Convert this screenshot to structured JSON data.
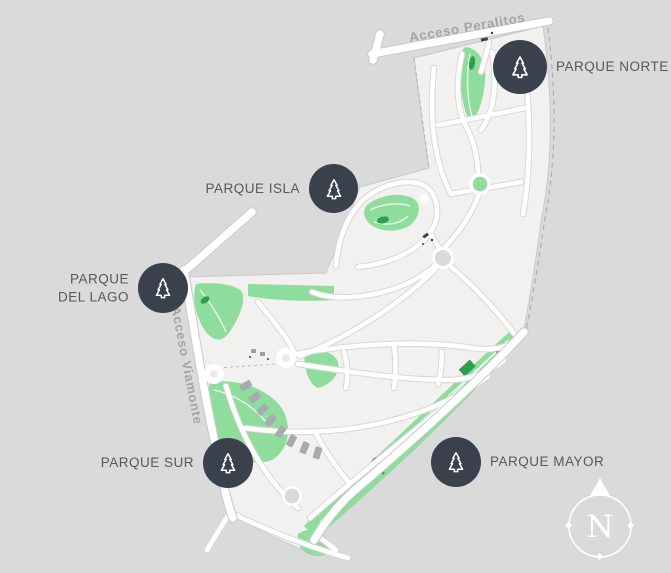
{
  "map": {
    "colors": {
      "background": "#dadada",
      "parcel": "#f2f1f0",
      "road": "#ffffff",
      "park_green": "#8edd9d",
      "park_green_dark": "#2f9e4f",
      "badge": "#3a404c",
      "park_label": "#54585f",
      "road_label": "#a2a2a2"
    },
    "roads": {
      "north": "Acceso Peralitos",
      "west": "Acceso Viamonte"
    },
    "parks": [
      {
        "id": "norte",
        "label": "PARQUE NORTE"
      },
      {
        "id": "isla",
        "label": "PARQUE ISLA"
      },
      {
        "id": "del_lago",
        "label": "PARQUE DEL LAGO"
      },
      {
        "id": "sur",
        "label": "PARQUE SUR"
      },
      {
        "id": "mayor",
        "label": "PARQUE MAYOR"
      }
    ],
    "compass": {
      "north_letter": "N"
    }
  }
}
